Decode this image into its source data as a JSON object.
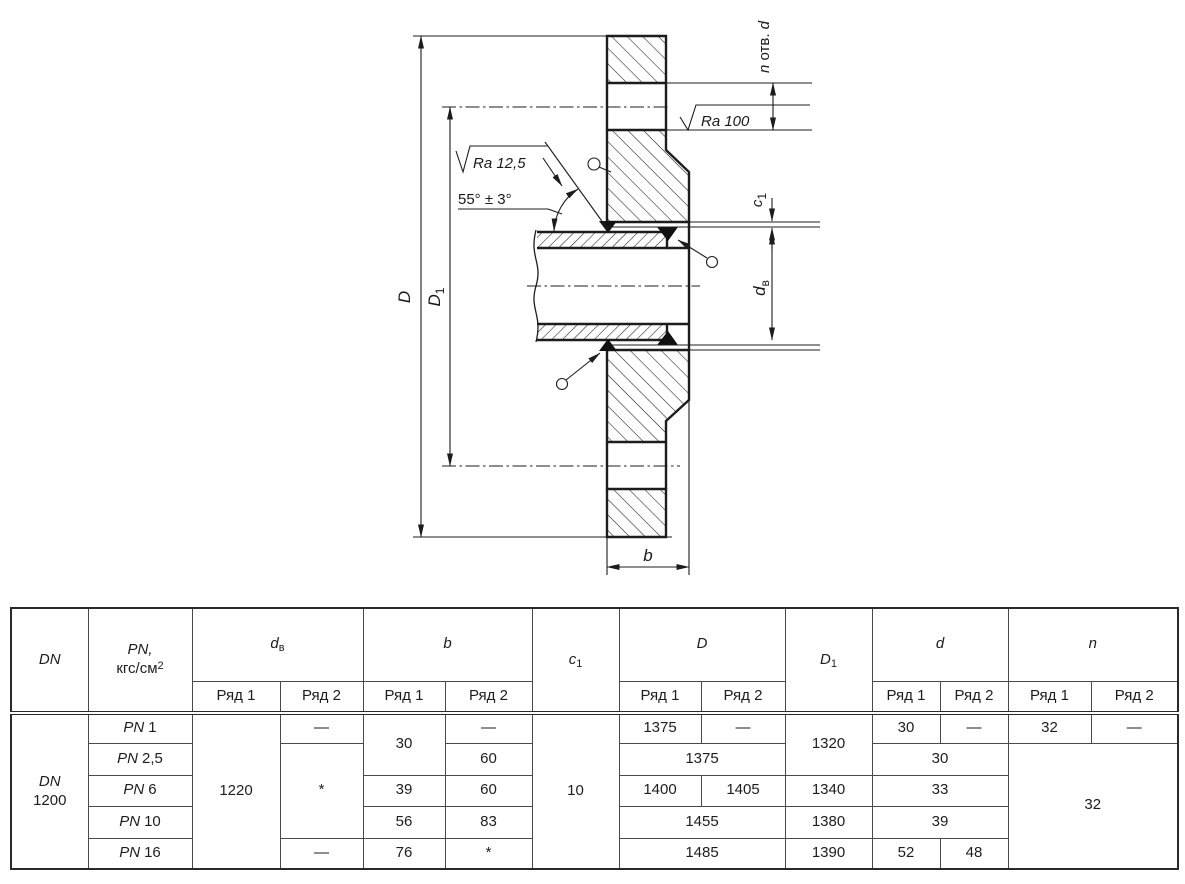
{
  "drawing": {
    "dim_D": "D",
    "dim_D1_main": "D",
    "dim_D1_sub": "1",
    "dim_dv_main": "d",
    "dim_dv_sub": "в",
    "dim_c1_main": "c",
    "dim_c1_sub": "1",
    "dim_b": "b",
    "holes_n": "n",
    "holes_otv": " отв. ",
    "holes_d": "d",
    "ra_face": "Ra 100",
    "ra_bevel": "Ra 12,5",
    "bevel_angle": "55° ± 3°"
  },
  "table": {
    "headers": {
      "dn": "DN",
      "pn_line1": "PN,",
      "pn_line2": "кгс/см",
      "pn_sup": "2",
      "dv_main": "d",
      "dv_sub": "в",
      "b": "b",
      "c1_main": "c",
      "c1_sub": "1",
      "D": "D",
      "D1_main": "D",
      "D1_sub": "1",
      "d": "d",
      "n": "n",
      "ryad1": "Ряд 1",
      "ryad2": "Ряд 2"
    },
    "dn_cell": {
      "line1": "DN",
      "line2": "1200"
    },
    "pn_prefix": "PN",
    "pn_values": [
      "1",
      "2,5",
      "6",
      "10",
      "16"
    ],
    "body": {
      "dv_r1": "1220",
      "dv_r2_pn1": "—",
      "dv_r2_mid": "*",
      "dv_r2_pn16": "—",
      "b_r1_pn1": "30",
      "b_r1_pn6": "39",
      "b_r1_pn10": "56",
      "b_r1_pn16": "76",
      "b_r2_pn1": "—",
      "b_r2_pn25": "60",
      "b_r2_pn6": "60",
      "b_r2_pn10": "83",
      "b_r2_pn16": "*",
      "c1": "10",
      "D_r1_pn1": "1375",
      "D_r2_pn1": "—",
      "D_pn25": "1375",
      "D_r1_pn6": "1400",
      "D_r2_pn6": "1405",
      "D_pn10": "1455",
      "D_pn16": "1485",
      "D1_pn1": "1320",
      "D1_pn6": "1340",
      "D1_pn10": "1380",
      "D1_pn16": "1390",
      "d_r1_pn1": "30",
      "d_r2_pn1": "—",
      "d_pn25": "30",
      "d_pn6": "33",
      "d_pn10": "39",
      "d_r1_pn16": "52",
      "d_r2_pn16": "48",
      "n_r1_pn1": "32",
      "n_r2_pn1": "—",
      "n_rest": "32"
    }
  }
}
